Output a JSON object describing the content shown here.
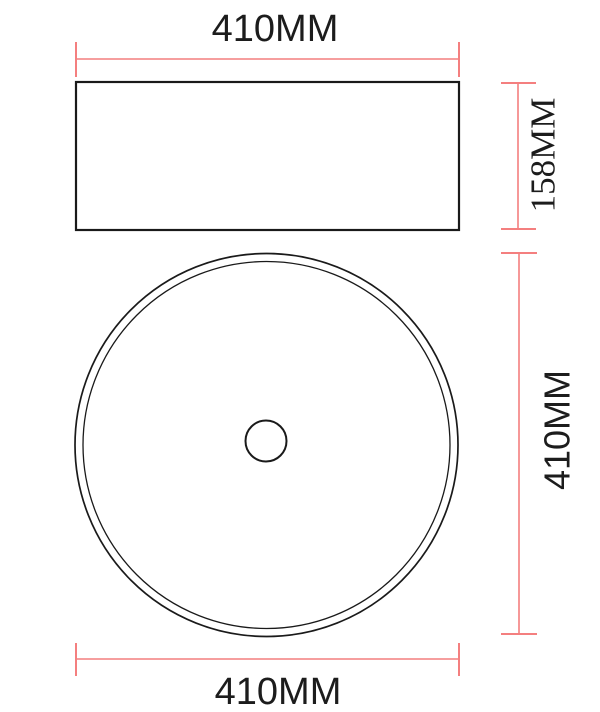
{
  "drawing": {
    "labels": {
      "top_width": "410MM",
      "side_height": "158MM",
      "diameter_right": "410MM",
      "diameter_bottom": "410MM"
    },
    "colors": {
      "dimension_line": "#f47f7f",
      "outline": "#1a1a1a",
      "background": "#ffffff"
    }
  }
}
